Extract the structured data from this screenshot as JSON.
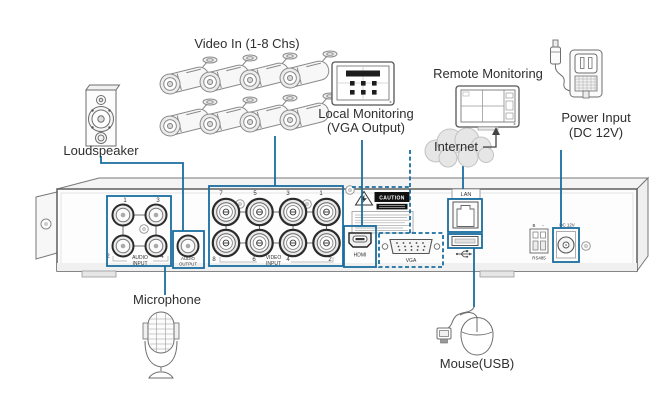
{
  "colors": {
    "accent": "#1a6d9f",
    "ink": "#4a4a4a",
    "caution_bg": "#111111"
  },
  "labels": {
    "video_in": "Video In (1-8 Chs)",
    "loudspeaker": "Loudspeaker",
    "local_monitoring_line1": "Local Monitoring",
    "local_monitoring_line2": "(VGA Output)",
    "remote_monitoring": "Remote Monitoring",
    "internet": "Internet",
    "power_input_line1": "Power Input",
    "power_input_line2": "(DC 12V)",
    "microphone": "Microphone",
    "mouse": "Mouse(USB)"
  },
  "panel": {
    "audio_input": {
      "word1": "AUDIO",
      "word2": "INPUT",
      "n_tl": "1",
      "n_tr": "3",
      "n_bl": "2",
      "n_br": "4"
    },
    "audio_output": {
      "word1": "AUDIO",
      "word2": "OUTPUT"
    },
    "video_input": {
      "word1": "VIDEO",
      "word2": "INPUT",
      "top": [
        "7",
        "5",
        "3",
        "1"
      ],
      "bottom": [
        "8",
        "6",
        "4",
        "2"
      ]
    },
    "caution": {
      "title": "CAUTION"
    },
    "ports": {
      "hdmi": "HDMI",
      "vga": "VGA",
      "lan": "LAN",
      "rs485": "RS485",
      "rs485_pin_b": "B",
      "rs485_pin_minus": "-",
      "dc": "DC 12V"
    }
  }
}
